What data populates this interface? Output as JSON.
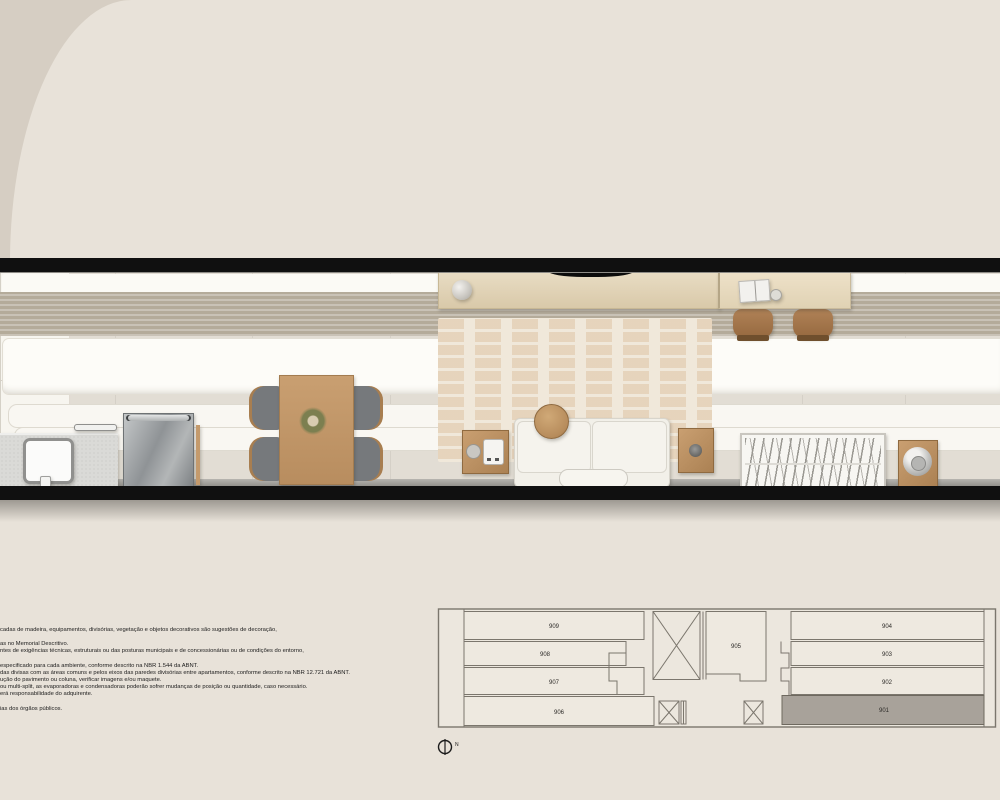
{
  "palette": {
    "background": "#e8e2d9",
    "corner_shade": "#d6cec3",
    "plan_wall": "#101010",
    "floor_tile": "#e2ddd4",
    "rug": "#f0e8da",
    "wood": "#c2996b",
    "light_wood": "#e0d2b6",
    "sofa_white": "#f2f0e9",
    "bed_throw": "#b4ab9a",
    "keyplan_line": "#7b766d",
    "keyplan_fill": "#ece7de",
    "keyplan_highlight": "#a8a29a",
    "text": "#1b1b1b"
  },
  "keyplan": {
    "units": [
      {
        "label": "909",
        "highlighted": false
      },
      {
        "label": "908",
        "highlighted": false
      },
      {
        "label": "907",
        "highlighted": false
      },
      {
        "label": "906",
        "highlighted": false
      },
      {
        "label": "905",
        "highlighted": false
      },
      {
        "label": "904",
        "highlighted": false
      },
      {
        "label": "903",
        "highlighted": false
      },
      {
        "label": "902",
        "highlighted": false
      },
      {
        "label": "901",
        "highlighted": true
      }
    ],
    "north_label": "N"
  },
  "disclaimer": {
    "lines": [
      "cadas de madeira, equipamentos, divisórias, vegetação e objetos decorativos são sugestões de decoração,",
      "as no Memorial Descritivo.",
      "ntes de exigências técnicas, estruturais ou das posturas municipais e de concessionárias ou de condições do entorno,",
      "especificado para cada ambiente, conforme descrito na NBR 1.544 da ABNT.",
      "das divisas com as áreas comuns e pelos eixos das paredes divisórias entre apartamentos, conforme descrito na NBR 12.721 da ABNT.",
      "ução do pavimento ou coluna, verificar imagens e/ou maquete.",
      "ou multi-split, as evaporadoras e condensadoras poderão sofrer mudanças de posição ou quantidade, caso necessário.",
      "erá responsabilidade do adquirente.",
      "ias dos órgãos públicos."
    ]
  }
}
